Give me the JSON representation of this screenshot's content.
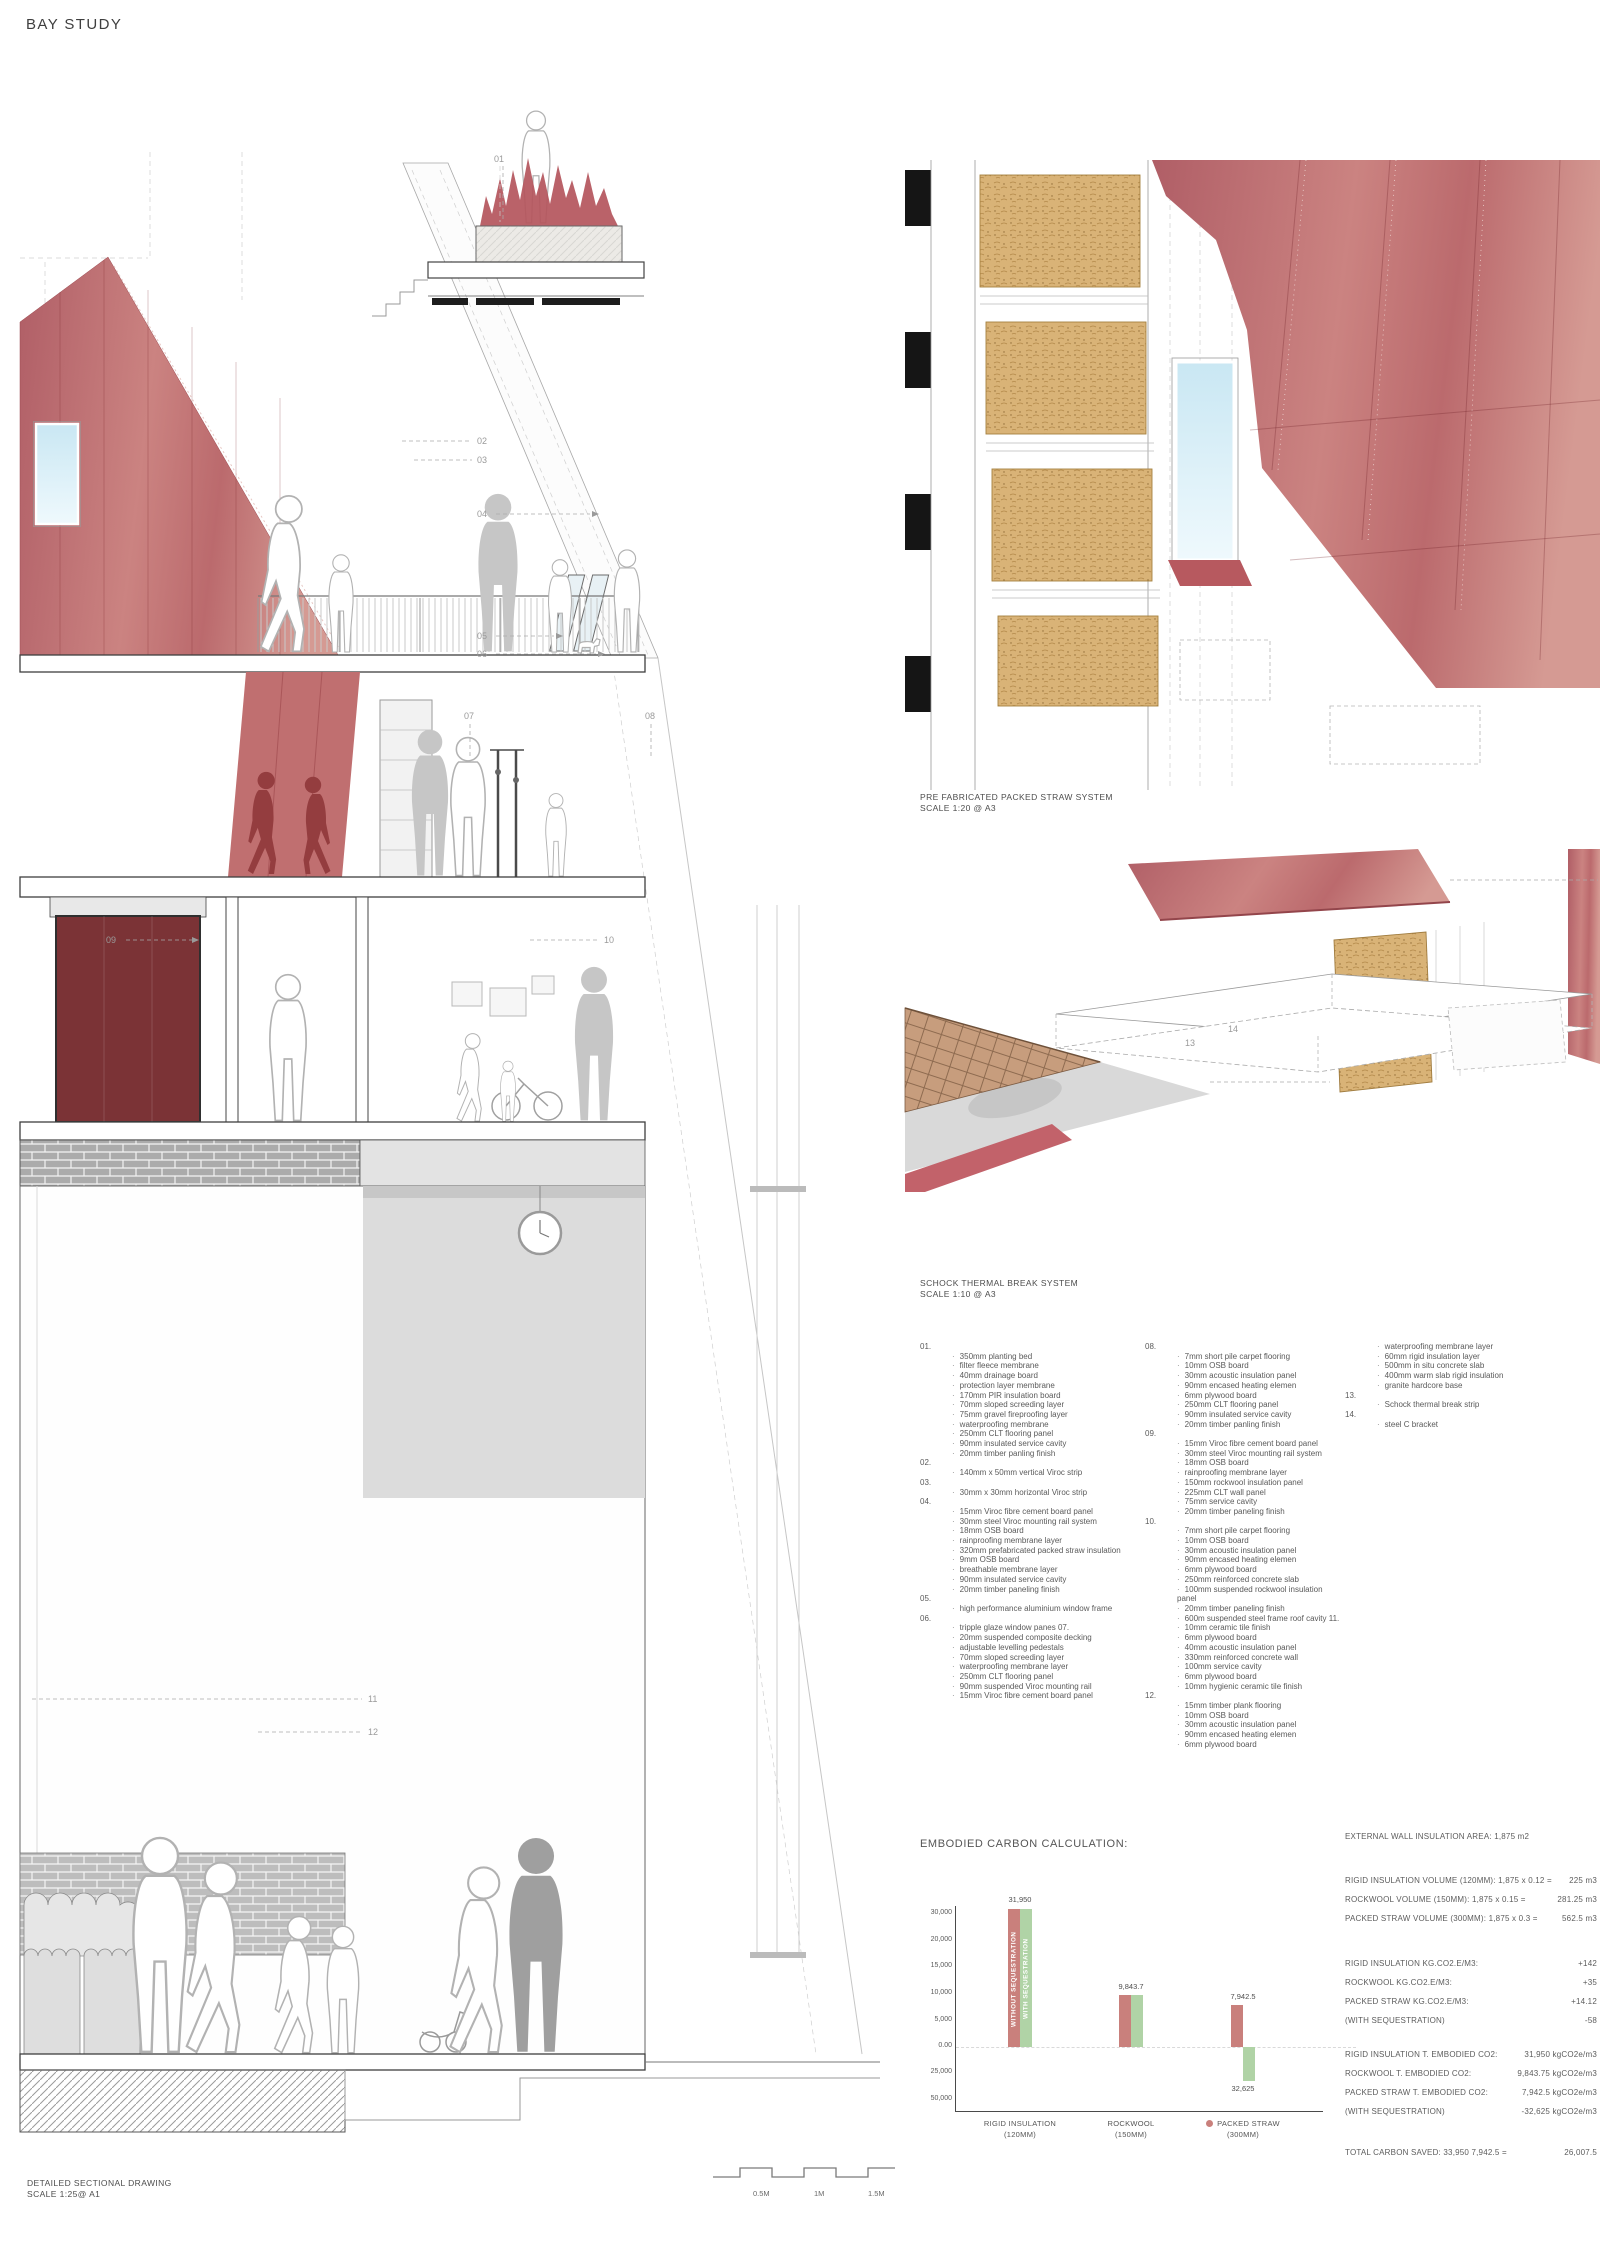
{
  "page": {
    "title": "BAY STUDY"
  },
  "labels": {
    "detail1": {
      "l1": "PRE FABRICATED PACKED STRAW SYSTEM",
      "l2": "SCALE 1:20 @ A3"
    },
    "detail2": {
      "l1": "SCHOCK THERMAL BREAK SYSTEM",
      "l2": "SCALE 1:10 @ A3"
    },
    "section": {
      "l1": "DETAILED SECTIONAL DRAWING",
      "l2": "SCALE 1:25@ A1"
    },
    "scalebar": [
      "0.5M",
      "1M",
      "1.5M"
    ]
  },
  "callouts": {
    "c01": "01",
    "c02": "02",
    "c03": "03",
    "c04": "04",
    "c05": "05",
    "c06": "06",
    "c07": "07",
    "c08": "08",
    "c09": "09",
    "c10": "10",
    "c11": "11",
    "c12": "12",
    "c13": "13",
    "c14": "14"
  },
  "legend": {
    "col1": [
      [
        "01.",
        ""
      ],
      [
        "",
        "350mm planting bed"
      ],
      [
        "",
        "filter fleece membrane"
      ],
      [
        "",
        "40mm drainage board"
      ],
      [
        "",
        "protection layer membrane"
      ],
      [
        "",
        "170mm PIR insulation board"
      ],
      [
        "",
        "70mm sloped screeding layer"
      ],
      [
        "",
        "75mm gravel fireproofing layer"
      ],
      [
        "",
        "waterproofing membrane"
      ],
      [
        "",
        "250mm CLT flooring panel"
      ],
      [
        "",
        "90mm insulated service cavity"
      ],
      [
        "",
        "20mm timber panling finish"
      ],
      [
        "",
        ""
      ],
      [
        "02.",
        ""
      ],
      [
        "",
        "140mm x 50mm vertical Viroc strip"
      ],
      [
        "",
        ""
      ],
      [
        "03.",
        ""
      ],
      [
        "",
        "30mm x 30mm horizontal Viroc strip"
      ],
      [
        "",
        ""
      ],
      [
        "04.",
        ""
      ],
      [
        "",
        "15mm Viroc fibre cement board panel"
      ],
      [
        "",
        "30mm steel Viroc mounting rail system"
      ],
      [
        "",
        "18mm OSB board"
      ],
      [
        "",
        "rainproofing membrane layer"
      ],
      [
        "",
        "320mm prefabricated packed straw insulation"
      ],
      [
        "",
        "9mm OSB board"
      ],
      [
        "",
        "breathable membrane layer"
      ],
      [
        "",
        "90mm insulated service cavity"
      ],
      [
        "",
        "20mm timber paneling finish"
      ],
      [
        "",
        ""
      ],
      [
        "05.",
        ""
      ],
      [
        "",
        "high performance aluminium window frame"
      ],
      [
        "",
        ""
      ],
      [
        "06.",
        ""
      ],
      [
        "",
        "tripple glaze window panes 07."
      ],
      [
        "",
        "20mm suspended composite decking"
      ],
      [
        "",
        "adjustable levelling pedestals"
      ],
      [
        "",
        "70mm sloped screeding layer"
      ],
      [
        "",
        "waterproofing membrane layer"
      ],
      [
        "",
        "250mm CLT flooring panel"
      ],
      [
        "",
        "90mm suspended Viroc mounting rail"
      ],
      [
        "",
        "15mm Viroc fibre cement board panel"
      ]
    ],
    "col2": [
      [
        "08.",
        ""
      ],
      [
        "",
        "7mm short pile carpet flooring"
      ],
      [
        "",
        "10mm OSB board"
      ],
      [
        "",
        "30mm acoustic insulation panel"
      ],
      [
        "",
        "90mm encased heating elemen"
      ],
      [
        "",
        "6mm plywood board"
      ],
      [
        "",
        "250mm CLT flooring panel"
      ],
      [
        "",
        "90mm insulated service cavity"
      ],
      [
        "",
        "20mm timber panling finish"
      ],
      [
        "",
        ""
      ],
      [
        "09.",
        ""
      ],
      [
        "",
        "15mm Viroc fibre cement board panel"
      ],
      [
        "",
        "30mm steel Viroc mounting rail system"
      ],
      [
        "",
        "18mm OSB board"
      ],
      [
        "",
        "rainproofing membrane layer"
      ],
      [
        "",
        "150mm rockwool insulation panel"
      ],
      [
        "",
        "225mm CLT wall panel"
      ],
      [
        "",
        "75mm service cavity"
      ],
      [
        "",
        "20mm timber paneling finish"
      ],
      [
        "",
        ""
      ],
      [
        "10.",
        ""
      ],
      [
        "",
        "7mm short pile carpet flooring"
      ],
      [
        "",
        "10mm OSB board"
      ],
      [
        "",
        "30mm acoustic insulation panel"
      ],
      [
        "",
        "90mm encased heating elemen"
      ],
      [
        "",
        "6mm plywood board"
      ],
      [
        "",
        "250mm reinforced concrete slab"
      ],
      [
        "",
        "100mm suspended rockwool insulation panel"
      ],
      [
        "",
        "20mm timber paneling finish"
      ],
      [
        "",
        "600m suspended steel frame roof cavity 11."
      ],
      [
        "",
        "10mm ceramic tile finish"
      ],
      [
        "",
        "6mm plywood board"
      ],
      [
        "",
        "40mm acoustic insulation panel"
      ],
      [
        "",
        "330mm reinforced concrete wall"
      ],
      [
        "",
        "100mm service cavity"
      ],
      [
        "",
        "6mm plywood board"
      ],
      [
        "",
        "10mm hygienic ceramic tile finish"
      ],
      [
        "",
        ""
      ],
      [
        "12.",
        ""
      ],
      [
        "",
        "15mm timber plank flooring"
      ],
      [
        "",
        "10mm OSB board"
      ],
      [
        "",
        "30mm acoustic insulation panel"
      ],
      [
        "",
        "90mm encased heating elemen"
      ],
      [
        "",
        "6mm plywood board"
      ]
    ],
    "col3": [
      [
        "",
        "waterproofing membrane layer"
      ],
      [
        "",
        "60mm rigid insulation layer"
      ],
      [
        "",
        "500mm in situ concrete slab"
      ],
      [
        "",
        "400mm warm slab rigid insulation"
      ],
      [
        "",
        "granite hardcore base"
      ],
      [
        "",
        ""
      ],
      [
        "13.",
        ""
      ],
      [
        "",
        "Schock thermal break strip"
      ],
      [
        "",
        ""
      ],
      [
        "14.",
        ""
      ],
      [
        "",
        "steel C bracket"
      ]
    ]
  },
  "calc": {
    "area": [
      {
        "l": "EXTERNAL WALL INSULATION AREA: 1,875 m2",
        "v": ""
      }
    ],
    "volumes": [
      {
        "l": "RIGID INSULATION VOLUME (120MM): 1,875 x 0.12 =",
        "v": "225 m3"
      },
      {
        "l": "ROCKWOOL VOLUME (150MM): 1,875 x 0.15 =",
        "v": "281.25 m3"
      },
      {
        "l": "PACKED STRAW VOLUME (300MM): 1,875 x 0.3 =",
        "v": "562.5 m3"
      }
    ],
    "factors": [
      {
        "l": "RIGID INSULATION KG.CO2.E/M3:",
        "v": "+142"
      },
      {
        "l": "ROCKWOOL  KG.CO2.E/M3:",
        "v": "+35"
      },
      {
        "l": "PACKED STRAW KG.CO2.E/M3:",
        "v": "+14.12"
      },
      {
        "l": "(WITH SEQUESTRATION)",
        "v": "-58"
      }
    ],
    "totals": [
      {
        "l": "RIGID INSULATION T. EMBODIED CO2:",
        "v": "31,950 kgCO2e/m3"
      },
      {
        "l": "ROCKWOOL T. EMBODIED CO2:",
        "v": "9,843.75 kgCO2e/m3"
      },
      {
        "l": "PACKED STRAW T. EMBODIED CO2:",
        "v": "7,942.5 kgCO2e/m3"
      },
      {
        "l": "(WITH SEQUESTRATION)",
        "v": "-32,625 kgCO2e/m3"
      }
    ],
    "saved": [
      {
        "l": "TOTAL CARBON SAVED: 33,950  7,942.5 =",
        "v": "26,007.5"
      }
    ]
  },
  "chart_data": {
    "type": "bar",
    "title": "EMBODIED CARBON CALCULATION:",
    "categories": [
      [
        "RIGID INSULATION",
        "(120MM)"
      ],
      [
        "ROCKWOOL",
        "(150MM)"
      ],
      [
        "PACKED STRAW",
        "(300MM)"
      ]
    ],
    "series": [
      {
        "name": "without sequestration",
        "color": "#c9807c",
        "values": [
          31950,
          9843.7,
          7942.5
        ]
      },
      {
        "name": "with sequestration",
        "color": "#b0d3a6",
        "values": [
          31950,
          9843.7,
          -32625
        ]
      }
    ],
    "bar_labels": {
      "g0_top": "31,950",
      "g1_top": "9,843.7",
      "g2_top": "7,942.5",
      "g2_bottom": "32,625"
    },
    "yticks": [
      "30,000",
      "20,000",
      "15,000",
      "10,000",
      "5,000",
      "0.00",
      "25,000",
      "50,000"
    ],
    "ytick_values": [
      30000,
      20000,
      15000,
      10000,
      5000,
      0,
      -25000,
      -50000
    ],
    "ylim": [
      -50000,
      32000
    ],
    "zero_line": "dashed",
    "legend_position": "x-axis inline",
    "grid": false
  }
}
